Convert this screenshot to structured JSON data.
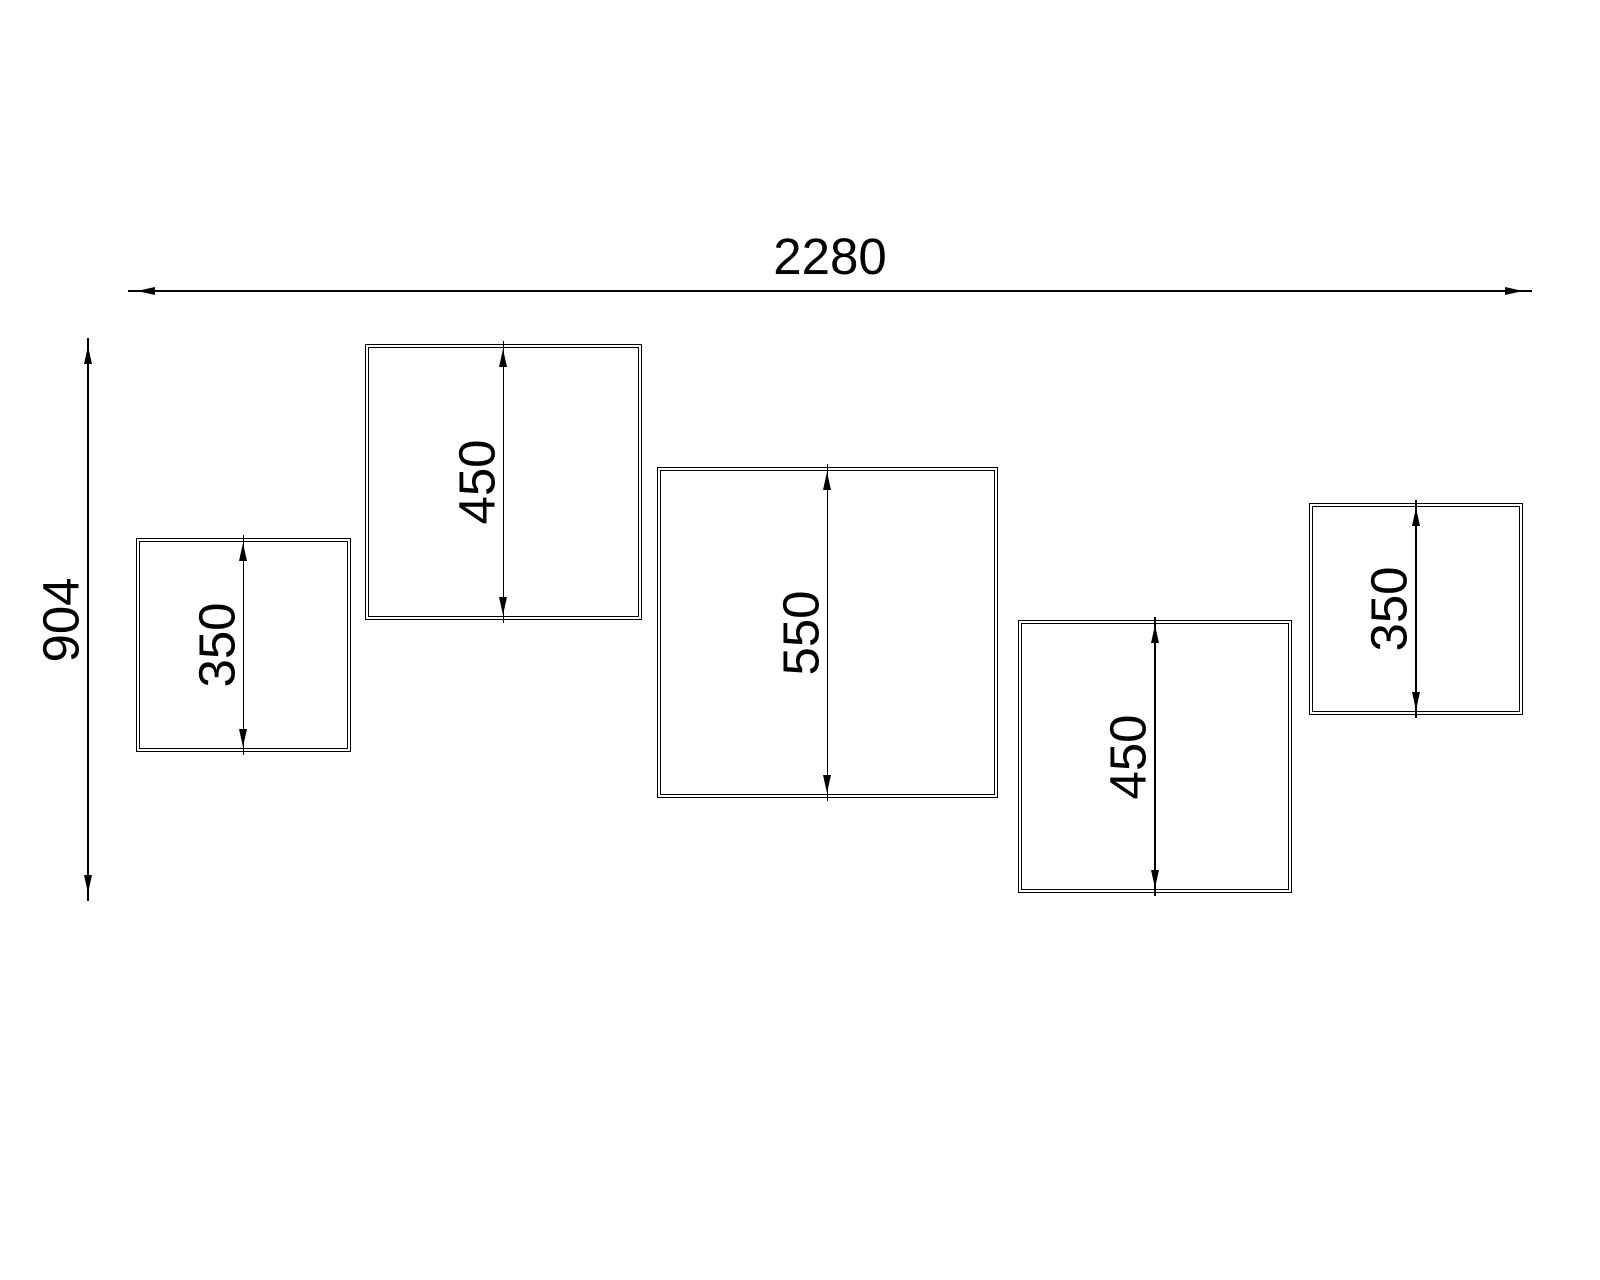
{
  "drawing": {
    "overall": {
      "width_label": "2280",
      "height_label": "904"
    },
    "boxes": [
      {
        "label": "350"
      },
      {
        "label": "450"
      },
      {
        "label": "550"
      },
      {
        "label": "450"
      },
      {
        "label": "350"
      }
    ]
  },
  "colors": {
    "line": "#000000",
    "background": "#ffffff",
    "text": "#000000"
  }
}
